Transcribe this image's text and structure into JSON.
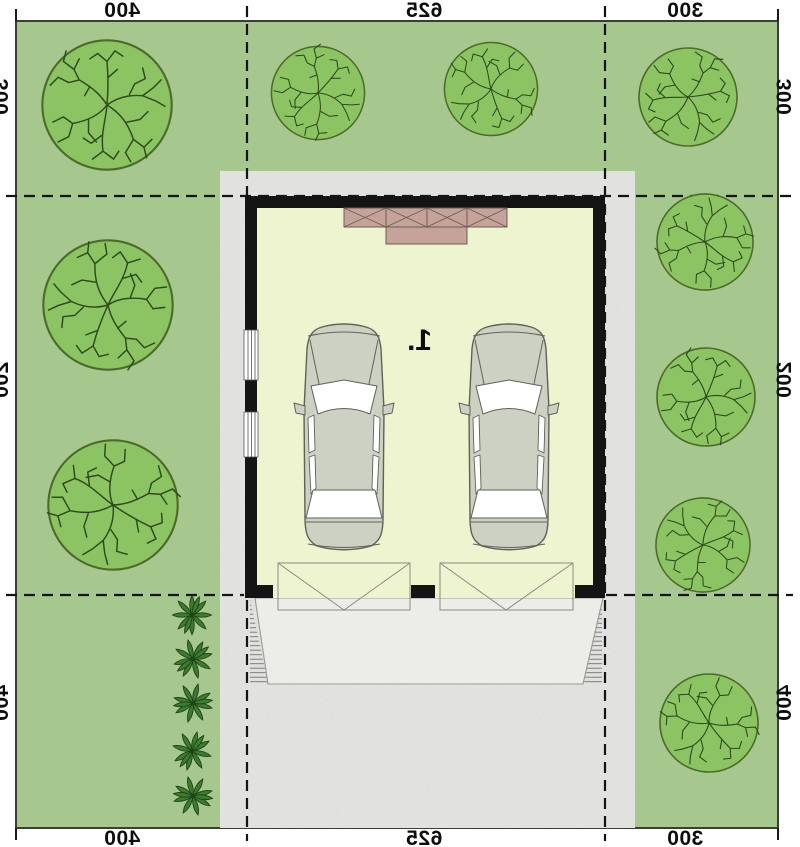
{
  "plan": {
    "room_label": "1.",
    "dims": {
      "top": [
        "400",
        "625",
        "300"
      ],
      "bottom": [
        "400",
        "625",
        "300"
      ],
      "left": [
        "300",
        "200",
        "400"
      ],
      "right": [
        "300",
        "200",
        "400"
      ]
    },
    "colors": {
      "lawn": "#a6c78d",
      "tree_fill": "#8cc464",
      "tree_stroke": "#4c6b2a",
      "branch": "#2c4a1a",
      "driveway": "#e6e6e4",
      "apron": "#ececE9",
      "garage_floor": "#eef3d0",
      "wall": "#141414",
      "attic_unit": "#c5a39a",
      "car_body": "#cdd1c3",
      "shrub": "#3f7a31",
      "dash_line": "#141414"
    }
  }
}
